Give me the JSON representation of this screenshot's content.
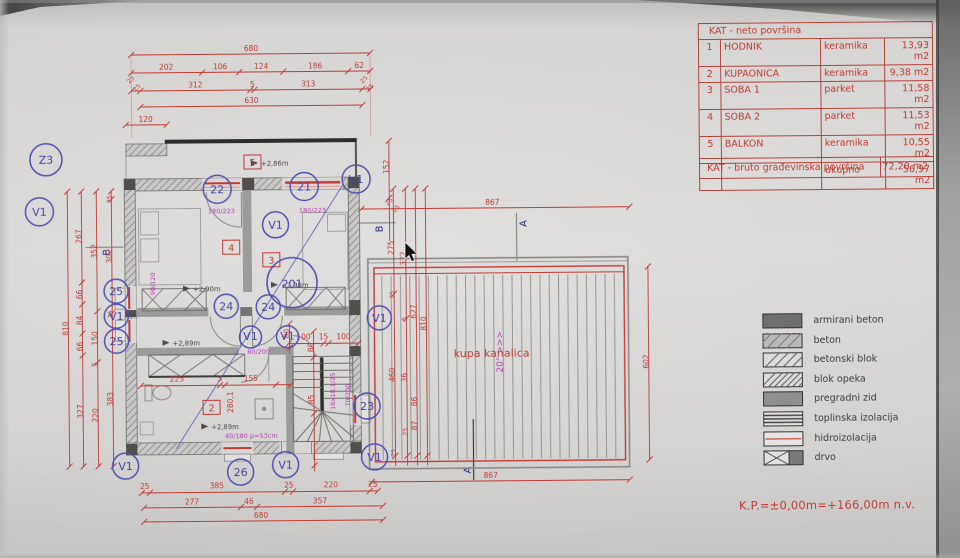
{
  "colors": {
    "dim_red": "#c13b36",
    "circle_blue": "#4343a8",
    "spec_magenta": "#b93db9",
    "paper_gray": "#d8d7d5",
    "wall_dark": "#4a4a48"
  },
  "area_table": {
    "title": "KAT - neto površina",
    "rows": [
      {
        "num": "1",
        "name": "HODNIK",
        "material": "keramika",
        "area": "13,93 m2"
      },
      {
        "num": "2",
        "name": "KUPAONICA",
        "material": "keramika",
        "area": "9,38 m2"
      },
      {
        "num": "3",
        "name": "SOBA 1",
        "material": "parket",
        "area": "11,58 m2"
      },
      {
        "num": "4",
        "name": "SOBA 2",
        "material": "parket",
        "area": "11,53 m2"
      },
      {
        "num": "5",
        "name": "BALKON",
        "material": "keramika",
        "area": "10,55 m2"
      }
    ],
    "total_label": "ukupno",
    "total_value": "56,97 m2"
  },
  "bruto_table": {
    "label": "KAT - bruto građevinska površina",
    "value": "72,20 m2"
  },
  "legend": {
    "items": [
      {
        "key": "armirani-beton",
        "label": "armirani beton"
      },
      {
        "key": "beton",
        "label": "beton"
      },
      {
        "key": "betonski-blok",
        "label": "betonski blok"
      },
      {
        "key": "blok-opeka",
        "label": "blok opeka"
      },
      {
        "key": "pregradni-zid",
        "label": "pregradni zid"
      },
      {
        "key": "toplinska-izolacija",
        "label": "toplinska izolacija"
      },
      {
        "key": "hidroizolacija",
        "label": "hidroizolacija"
      },
      {
        "key": "drvo",
        "label": "drvo"
      }
    ]
  },
  "footer": {
    "datum_note": "K.P.=±0,00m=+166,00m n.v."
  },
  "plan": {
    "room_tags": [
      "5",
      "4",
      "3",
      "2"
    ],
    "ref_bubble": "201",
    "circles": [
      "Z3",
      "V1",
      "25",
      "V1",
      "25",
      "V1",
      "22",
      "21",
      "V1",
      "V1",
      "24",
      "24",
      "V1",
      "V1",
      "23",
      "26",
      "V1",
      "V1",
      "V1"
    ],
    "levels": [
      "+2,86m",
      "+2,90m",
      "+2,90m",
      "+2,89m",
      "+2,89m"
    ],
    "specs": [
      "180/223",
      "180/223",
      "80/200",
      "40/180 p=53cm",
      "16x18,1/25",
      "70/200",
      "90/120"
    ],
    "roof": {
      "label": "kupa kanalica",
      "slope": "20° >>>"
    },
    "sections": {
      "a": "A",
      "b": "B"
    },
    "dims": {
      "top": [
        "680",
        "202",
        "106",
        "124",
        "186",
        "62",
        "312",
        "5",
        "313",
        "630",
        "120",
        "25",
        "25",
        "25",
        "25"
      ],
      "bottom": [
        "25",
        "385",
        "25",
        "220",
        "25",
        "277",
        "46",
        "357",
        "680"
      ],
      "left": [
        "810",
        "267",
        "66",
        "84",
        "66",
        "327",
        "352",
        "150",
        "5",
        "220",
        "25",
        "302",
        "25",
        "383"
      ],
      "mid": [
        "152",
        "25",
        "25",
        "275",
        "25",
        "460",
        "25",
        "372",
        "5",
        "36",
        "25",
        "627",
        "86",
        "87",
        "810"
      ],
      "right": [
        "602",
        "867",
        "867"
      ],
      "inner": [
        "225",
        "5",
        "155",
        "100",
        "15",
        "100",
        "280,1",
        "80",
        "80",
        "85"
      ]
    }
  }
}
